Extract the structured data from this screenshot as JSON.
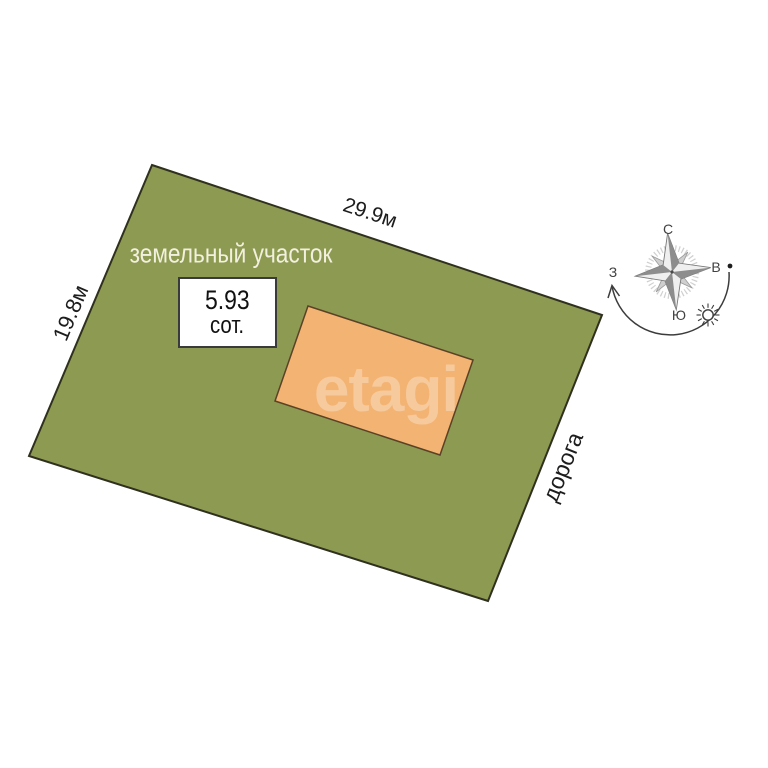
{
  "plot": {
    "name_label": "земельный участок",
    "top_dimension": "29.9м",
    "left_dimension": "19.8м",
    "road_label": "дорога",
    "area": {
      "value": "5.93",
      "unit": "сот."
    }
  },
  "watermark": {
    "text": "etagi"
  },
  "compass": {
    "north": "С",
    "east": "В",
    "west": "З",
    "south": "Ю"
  },
  "colors": {
    "plot_fill": "#8d9a52",
    "plot_outline": "#30301e",
    "building_fill": "#f3b373",
    "building_outline": "#5b4226",
    "plot_label_text": "#f2f0de",
    "dimension_text": "#1d1d1d"
  }
}
